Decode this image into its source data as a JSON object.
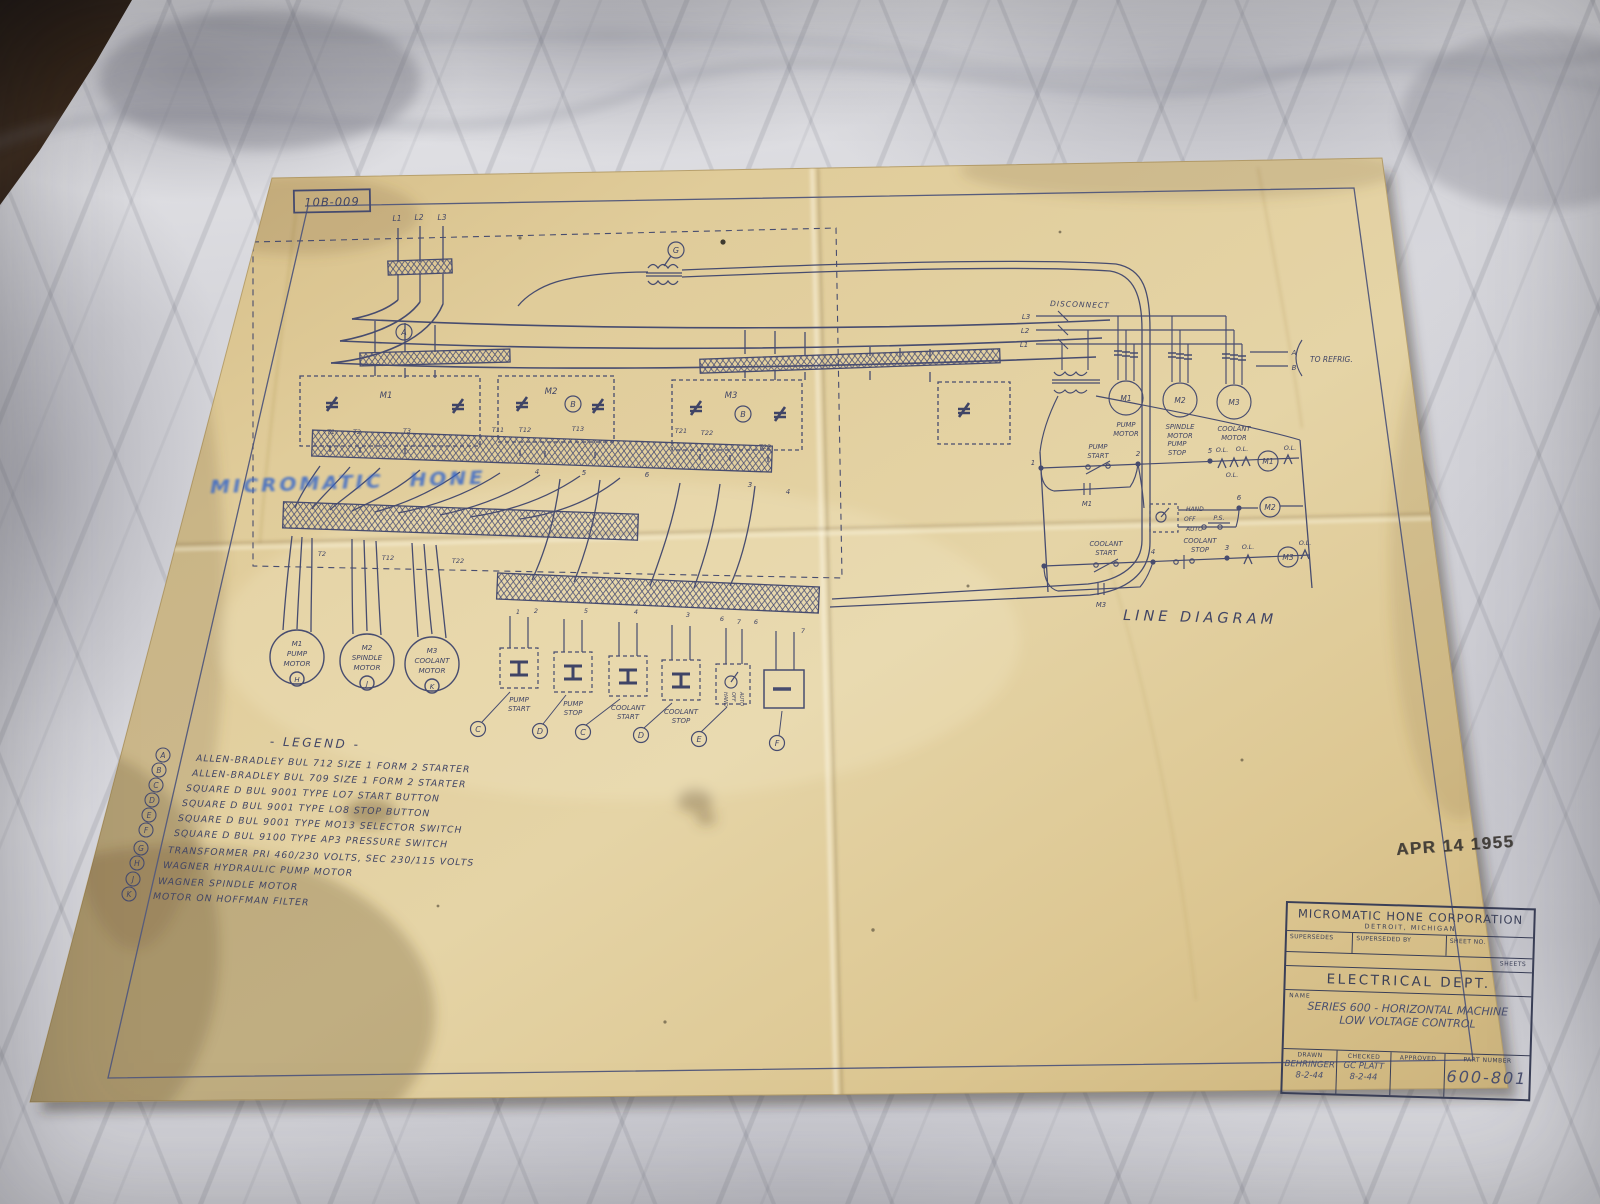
{
  "colors": {
    "paper": "#e0cb97",
    "ink": "#454a6e",
    "marker_blue": "#2f63cc",
    "stamp_black": "#3b3732",
    "marble_gray": "#d7d7db",
    "dark_corner": "#241a12"
  },
  "drawing_number": "10B-009",
  "handwritten_note": "MICROMATIC HONE",
  "date_stamp": "APR 14 1955",
  "schematic": {
    "phases": [
      "L1",
      "L2",
      "L3"
    ],
    "transformer_ref": "G",
    "starters": [
      {
        "label": "M1",
        "ref": "A"
      },
      {
        "label": "M2",
        "ref": "B"
      },
      {
        "label": "M3",
        "ref": "B"
      }
    ],
    "t_labels_upper": [
      "T1",
      "T2",
      "T3",
      "T11",
      "T12",
      "T13",
      "T21",
      "T22",
      "T23"
    ],
    "t_labels_lower": [
      "T2",
      "T12",
      "T22"
    ],
    "duct_numbers_mid": [
      "4",
      "5",
      "6",
      "3",
      "4"
    ],
    "duct_numbers_lower": [
      "1",
      "2",
      "5",
      "4",
      "3",
      "6",
      "7",
      "6",
      "7"
    ],
    "motors": [
      {
        "id": "M1",
        "line1": "PUMP",
        "line2": "MOTOR",
        "ref": "H"
      },
      {
        "id": "M2",
        "line1": "SPINDLE",
        "line2": "MOTOR",
        "ref": "J"
      },
      {
        "id": "M3",
        "line1": "COOLANT",
        "line2": "MOTOR",
        "ref": "K"
      }
    ],
    "buttons": [
      {
        "line1": "PUMP",
        "line2": "START",
        "ref": "C"
      },
      {
        "line1": "PUMP",
        "line2": "STOP",
        "ref": "D"
      },
      {
        "line1": "COOLANT",
        "line2": "START",
        "ref": "C"
      },
      {
        "line1": "COOLANT",
        "line2": "STOP",
        "ref": "D"
      }
    ],
    "selector": {
      "word1": "HAND",
      "word2": "OFF",
      "word3": "AUTO",
      "ref": "E"
    },
    "pressure_switch_ref": "F"
  },
  "legend": {
    "title": "- LEGEND -",
    "items": [
      {
        "key": "A",
        "text": "ALLEN-BRADLEY BUL 712 SIZE 1 FORM 2 STARTER"
      },
      {
        "key": "B",
        "text": "ALLEN-BRADLEY BUL 709 SIZE 1 FORM 2 STARTER"
      },
      {
        "key": "C",
        "text": "SQUARE D BUL 9001 TYPE LO7 START BUTTON"
      },
      {
        "key": "D",
        "text": "SQUARE D BUL 9001 TYPE LO8 STOP BUTTON"
      },
      {
        "key": "E",
        "text": "SQUARE D BUL 9001 TYPE MO13 SELECTOR SWITCH"
      },
      {
        "key": "F",
        "text": "SQUARE D BUL 9100 TYPE AP3 PRESSURE SWITCH"
      },
      {
        "key": "G",
        "text": "TRANSFORMER PRI 460/230 VOLTS, SEC 230/115 VOLTS"
      },
      {
        "key": "H",
        "text": "WAGNER HYDRAULIC PUMP MOTOR"
      },
      {
        "key": "J",
        "text": "WAGNER SPINDLE MOTOR"
      },
      {
        "key": "K",
        "text": "MOTOR ON HOFFMAN FILTER"
      }
    ]
  },
  "line_diagram": {
    "title": "LINE DIAGRAM",
    "disconnect": "DISCONNECT",
    "phases": [
      "L3",
      "L2",
      "L1"
    ],
    "motor_ids": [
      "M1",
      "M2",
      "M3"
    ],
    "motor_names": [
      [
        "PUMP",
        "MOTOR"
      ],
      [
        "SPINDLE",
        "MOTOR"
      ],
      [
        "COOLANT",
        "MOTOR"
      ]
    ],
    "to_refrig": "TO REFRIG.",
    "terminals": [
      "A",
      "B"
    ],
    "pump_start": [
      "PUMP",
      "START"
    ],
    "pump_stop": [
      "PUMP",
      "STOP"
    ],
    "coolant_start": [
      "COOLANT",
      "START"
    ],
    "coolant_stop": [
      "COOLANT",
      "STOP"
    ],
    "seal_contacts": [
      "M1",
      "M3"
    ],
    "selector": {
      "hand": "HAND",
      "off": "OFF",
      "auto": "AUTO",
      "ps": "P.S."
    },
    "overload": "O.L.",
    "coils": [
      "M1",
      "M2",
      "M3"
    ],
    "nodes": [
      "1",
      "2",
      "5",
      "6",
      "4",
      "3"
    ]
  },
  "title_block": {
    "company": "MICROMATIC HONE CORPORATION",
    "location": "DETROIT, MICHIGAN",
    "supersedes": "SUPERSEDES",
    "superseded_by": "SUPERSEDED BY",
    "sheet_no": "SHEET NO.",
    "sheets": "SHEETS",
    "department": "ELECTRICAL DEPT.",
    "name_label": "NAME",
    "name_line1": "SERIES 600 - HORIZONTAL MACHINE",
    "name_line2": "LOW VOLTAGE CONTROL",
    "drawn_label": "DRAWN",
    "drawn_name": "BEHRINGER",
    "drawn_date": "8-2-44",
    "checked_label": "CHECKED",
    "checked_name": "GC PLATT",
    "checked_date": "8-2-44",
    "approved_label": "APPROVED",
    "part_number_label": "PART NUMBER",
    "part_number": "600-801"
  }
}
